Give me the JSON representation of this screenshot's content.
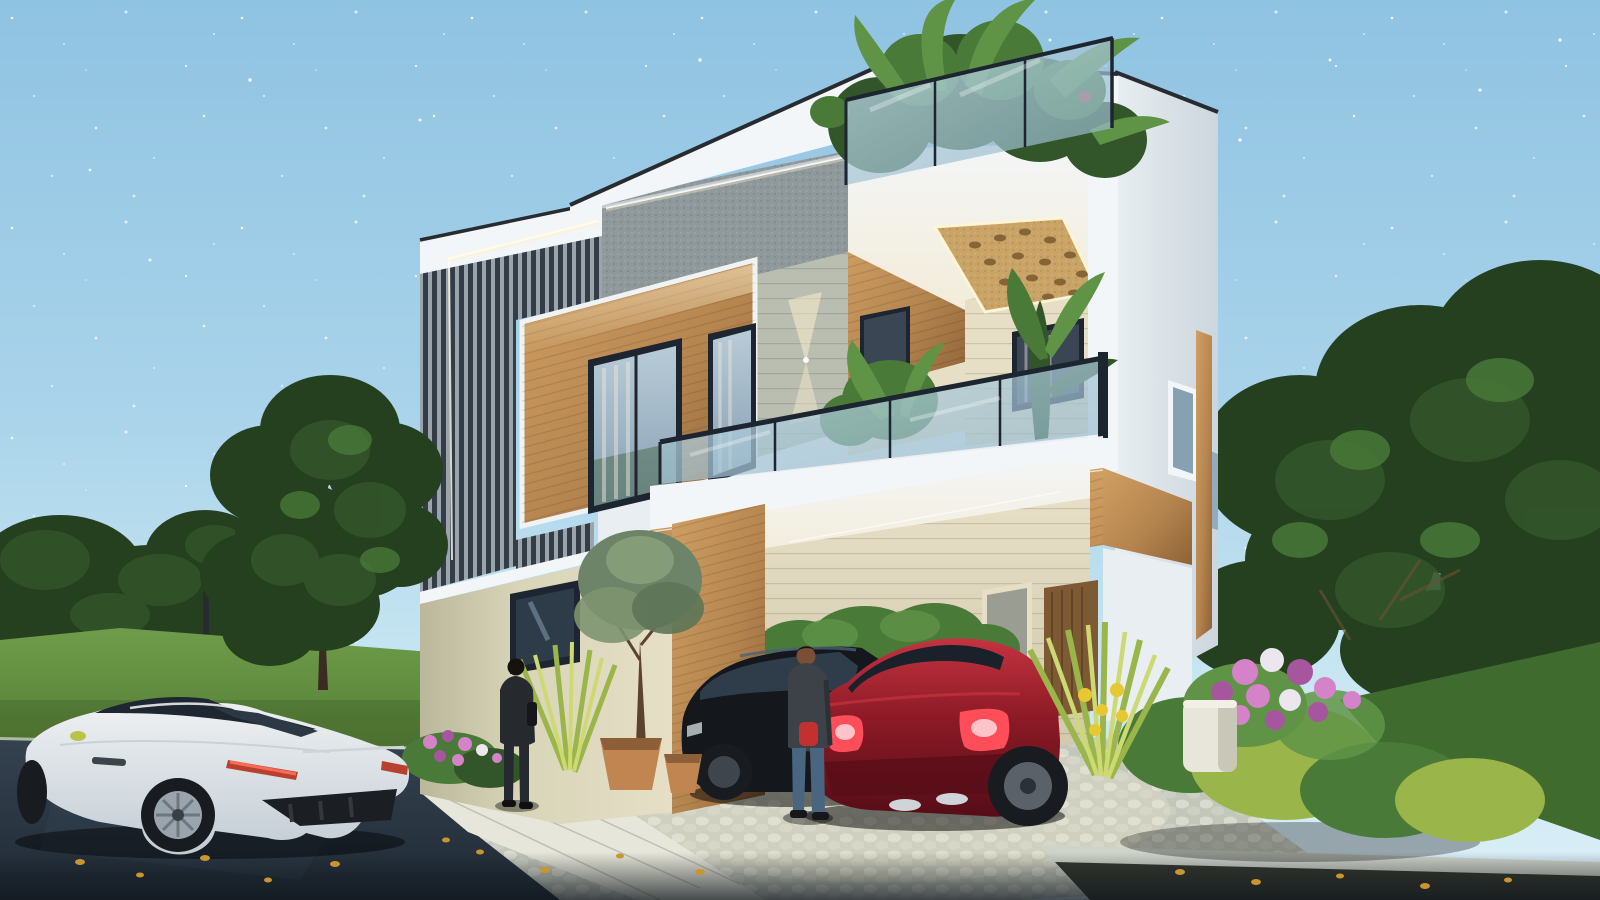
{
  "meta": {
    "type": "3d-architectural-rendering",
    "subject": "modern two-storey villa exterior at dusk with parked cars",
    "canvas": {
      "width": 1600,
      "height": 900
    },
    "time_of_day": "dusk with faint stars"
  },
  "palette": {
    "sky_top": "#8fc3e2",
    "sky_mid": "#a9d3ea",
    "sky_low": "#c8e6f2",
    "sky_horizon": "#dceff7",
    "star": "#ffffff",
    "tree_dark": "#24401f",
    "tree_mid": "#33552a",
    "tree_light": "#4a7a38",
    "tree_bright": "#5f9447",
    "lawn": "#557f36",
    "lawn_light": "#6f9c4a",
    "lawn_right": "#3f6b2e",
    "road_top": "#35424f",
    "road_bottom": "#1f2a35",
    "curb": "#cfd4cb",
    "cobble_bg": "#c2c7ba",
    "cobble_a": "#d8dbd0",
    "cobble_b": "#ccd0c4",
    "gravel": "#34382f",
    "walkway": "#e6e6da",
    "white_lit": "#f3f6f8",
    "white_mid": "#e8eef1",
    "white_shade": "#ccd6dd",
    "coping": "#272c31",
    "louver_dark": "#343d47",
    "louver_light": "#9aa4ab",
    "concrete": "#8f999b",
    "wood_light": "#cf9f63",
    "wood_mid": "#b5854f",
    "wood_dark": "#8d6237",
    "wood_door": "#7d5a33",
    "stone": "#b9beb1",
    "beige_lit": "#e6dfc6",
    "beige_shade": "#cfc6a9",
    "cream_wall": "#d8d5b8",
    "cream_shade": "#bab79b",
    "glass_hi": "#bcd7e3",
    "glass_lo": "#8fb4c8",
    "frame_dark": "#1d2530",
    "win_hi": "#b9cbd8",
    "win_lo": "#87a0b2",
    "gold": "#c9a466",
    "gold_dark": "#7a5a2e",
    "glow": "#fff3d0",
    "soffit_warm": "#f3ecd9",
    "jeans": "#4a6580",
    "jacket_dark": "#26292e",
    "jacket_gray": "#3d4248",
    "skin": "#7b4f35",
    "pouch_red": "#c23030",
    "car_white": "#eef1f3",
    "car_white_shade": "#c3ccd4",
    "car_glass": "#1e2630",
    "car_black": "#14181d",
    "car_black_hi": "#3d4f61",
    "car_red": "#8c1a26",
    "car_red_dark": "#550d17",
    "car_red_hi": "#c43340",
    "taillight": "#ff4d5a",
    "taillight_core": "#ffd0d4",
    "chrome": "#cfd4d8",
    "wheel_dark": "#181b20",
    "rim": "#9aa4ad",
    "pot": "#c08550",
    "pot_dark": "#8d5f39",
    "flower_pink": "#d583c8",
    "flower_purple": "#a855a0",
    "flower_white": "#ece6ee",
    "flower_yellow": "#e8c832",
    "spiky": "#9ab54a",
    "spiky_light": "#cdd973",
    "leaf_fall": "#c9952f",
    "shadow_dark": "#10161c"
  },
  "scene": {
    "sky": {
      "description": "clear dusk sky scattered with faint white stars"
    },
    "house": {
      "storeys": 2,
      "features": [
        "white rooftop parapet with dark coping and frameless glass roof railing",
        "rooftop terrace tropical plants and palms",
        "dark vertical louver screen panel on upper-left facade with warm LED cove lighting",
        "gray speckled concrete fascia band with LED strip",
        "warm wood cladding wall with two tall curtained windows",
        "textured stone strip with up-down wall washer light",
        "perforated golden jali ceiling panel with backlight",
        "first-floor balcony with frameless glass railing, ferns and planter",
        "wood-clad balcony slab band wrapping the corner",
        "double-height carport with wood portal frame",
        "beige stone carport back wall with gray door and wood door",
        "cream stucco ground-floor wall with small window",
        "white right side facade with small windows and wood corner strip"
      ]
    },
    "vehicles": [
      {
        "id": "white-sports-car",
        "description": "white coupe parked on dark asphalt road, rear three-quarter view, silver alloy wheels, red taillight strips"
      },
      {
        "id": "black-coupe",
        "description": "black coupe parked inside carport"
      },
      {
        "id": "maroon-coupe",
        "description": "dark red coupe in carport with bright lit taillights and chrome exhausts"
      }
    ],
    "people": [
      {
        "id": "man-walking-to-entrance",
        "description": "man in dark jacket and dark jeans walking toward house, back view"
      },
      {
        "id": "man-standing-by-cars",
        "description": "man in gray jacket, blue jeans with red pouch standing near cars, back view"
      }
    ],
    "landscaping": [
      "dense dark green trees on the left",
      "large trees on the right side",
      "green lawn strip on the left and behind right shrubs",
      "small olive tree by the entrance with terracotta pots",
      "spiky yellow-green ornamental grasses",
      "pink and purple flowering shrub beds",
      "bright green mounded bushes on the right",
      "white rounded gate pillar",
      "light cobblestone driveway, white paver walkway, stone curbs",
      "scattered fallen yellow leaves on the asphalt and paths",
      "thin street lamp post on the lawn"
    ]
  }
}
